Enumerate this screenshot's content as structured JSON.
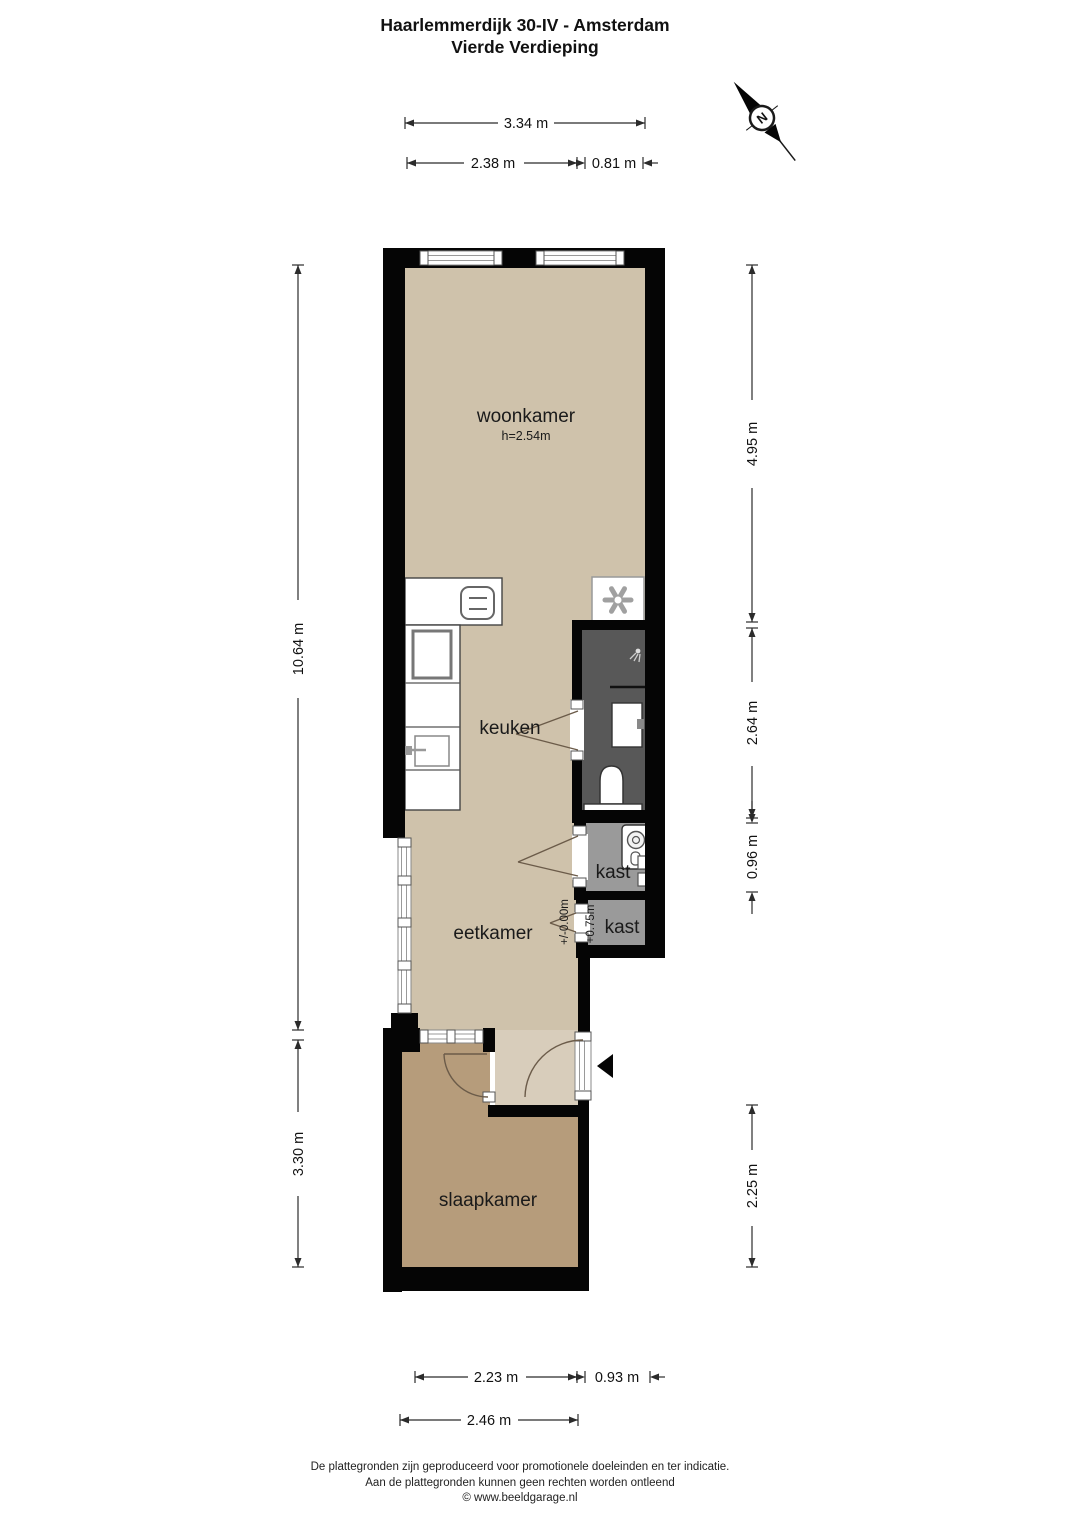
{
  "title": {
    "line1": "Haarlemmerdijk 30-IV - Amsterdam",
    "line2": "Vierde Verdieping"
  },
  "compass": {
    "label": "N"
  },
  "rooms": {
    "woonkamer": {
      "label": "woonkamer",
      "ceiling_height": "h=2.54m"
    },
    "keuken": {
      "label": "keuken"
    },
    "eetkamer": {
      "label": "eetkamer"
    },
    "kast_boven": {
      "label": "kast"
    },
    "kast_onder": {
      "label": "kast"
    },
    "slaapkamer": {
      "label": "slaapkamer"
    }
  },
  "floor_levels": {
    "eetkamer_level": "+/-0.00m",
    "kast_level": "+0.75m"
  },
  "dimensions": {
    "top_total": "3.34 m",
    "top_left": "2.38 m",
    "top_right": "0.81 m",
    "left_upper": "10.64 m",
    "left_lower": "3.30 m",
    "right_upper": "4.95 m",
    "right_middle": "2.64 m",
    "right_small": "0.96 m",
    "right_lower": "2.25 m",
    "bottom_left": "2.23 m",
    "bottom_small": "0.93 m",
    "bottom_total": "2.46 m"
  },
  "footer": {
    "line1": "De plattegronden zijn geproduceerd voor promotionele doeleinden en ter indicatie.",
    "line2": "Aan de plattegronden kunnen geen rechten worden ontleend",
    "line3": "© www.beeldgarage.nl"
  },
  "colors": {
    "wall": "#050505",
    "floor_main": "#cfc2ab",
    "floor_hall": "#d8cdbb",
    "floor_bedroom": "#b69c7b",
    "floor_bathroom": "#585858",
    "floor_closet": "#9a9a9a"
  }
}
